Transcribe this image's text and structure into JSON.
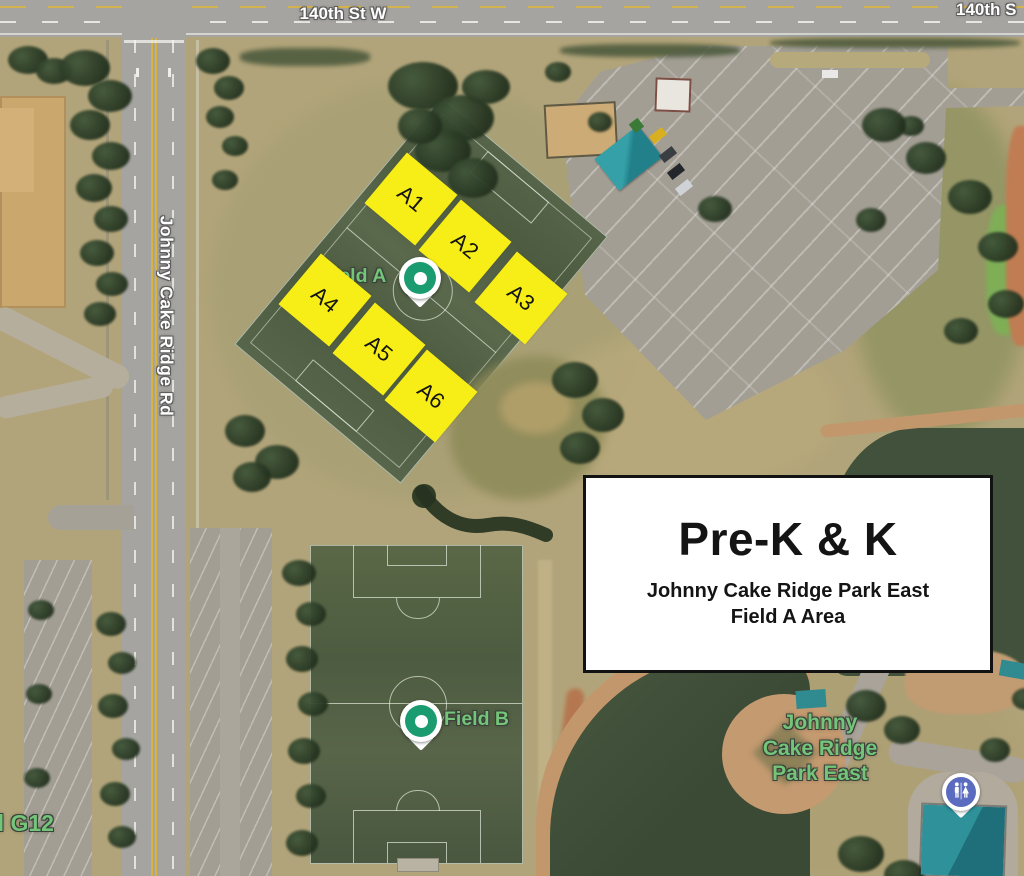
{
  "map": {
    "road_labels": {
      "top": "140th St W",
      "top_right_partial": "140th S",
      "left_vertical": "Johnny Cake Ridge Rd"
    },
    "field_squares": {
      "color": "#f8ee17",
      "items": [
        {
          "label": "A1"
        },
        {
          "label": "A2"
        },
        {
          "label": "A3"
        },
        {
          "label": "A4"
        },
        {
          "label": "A5"
        },
        {
          "label": "A6"
        }
      ]
    },
    "markers": {
      "field_a": {
        "label": "Field A",
        "pin_color": "#1b9c70"
      },
      "field_b": {
        "label": "Field B",
        "pin_color": "#1b9c70"
      },
      "restroom": {
        "icon": "restroom-icon",
        "pin_color": "#5b6bc0"
      }
    },
    "place_labels": {
      "park_east_line1": "Johnny",
      "park_east_line2": "Cake Ridge",
      "park_east_line3": "Park East",
      "bottom_left_partial": "d G12",
      "label_color": "#74c47a"
    }
  },
  "info_box": {
    "title": "Pre-K & K",
    "subtitle_line1": "Johnny Cake Ridge Park East",
    "subtitle_line2": "Field A Area",
    "background": "#ffffff",
    "border_color": "#121212"
  }
}
